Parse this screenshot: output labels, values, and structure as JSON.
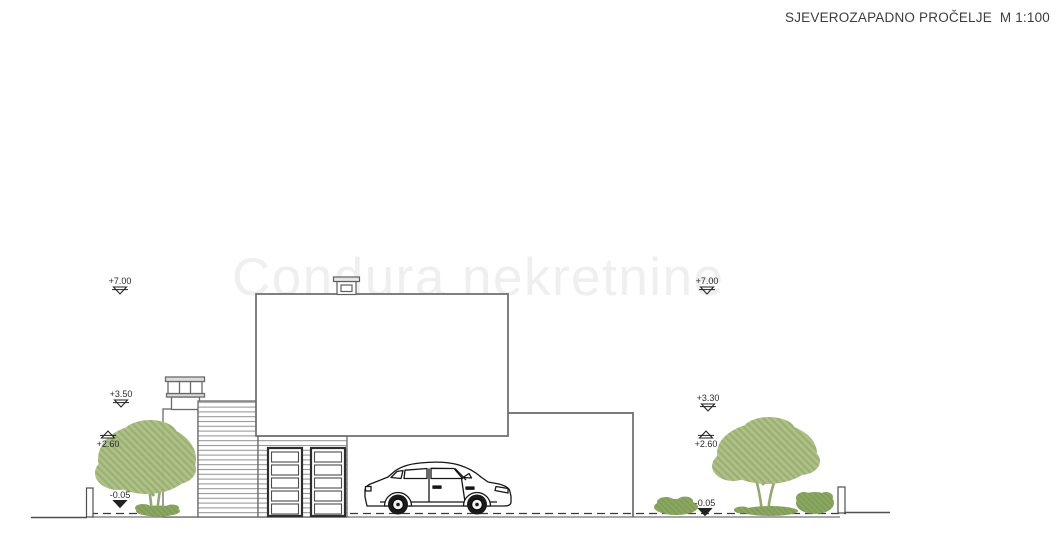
{
  "title": {
    "text": "SJEVEROZAPADNO PROČELJE  M 1:100"
  },
  "watermark": {
    "text": "Condura nekretnine"
  },
  "markers": {
    "left_plus700": "+7.00",
    "left_plus350": "+3.50",
    "left_plus260": "+2.60",
    "left_minus005": "-0.05",
    "right_plus700": "+7.00",
    "right_plus330": "+3.30",
    "right_plus260": "+2.60",
    "right_minus005": "-0.05"
  },
  "drawing_labels": {
    "view": "northwest-facade-elevation",
    "scale": "1:100"
  },
  "colors": {
    "line_gray": "#6a6a6a",
    "dark_line": "#2e2e2e",
    "tree_green": "#a6ba7e",
    "bush_green": "#8aa661",
    "watermark_gray": "#efefef",
    "title_text": "#3d3d3d"
  }
}
